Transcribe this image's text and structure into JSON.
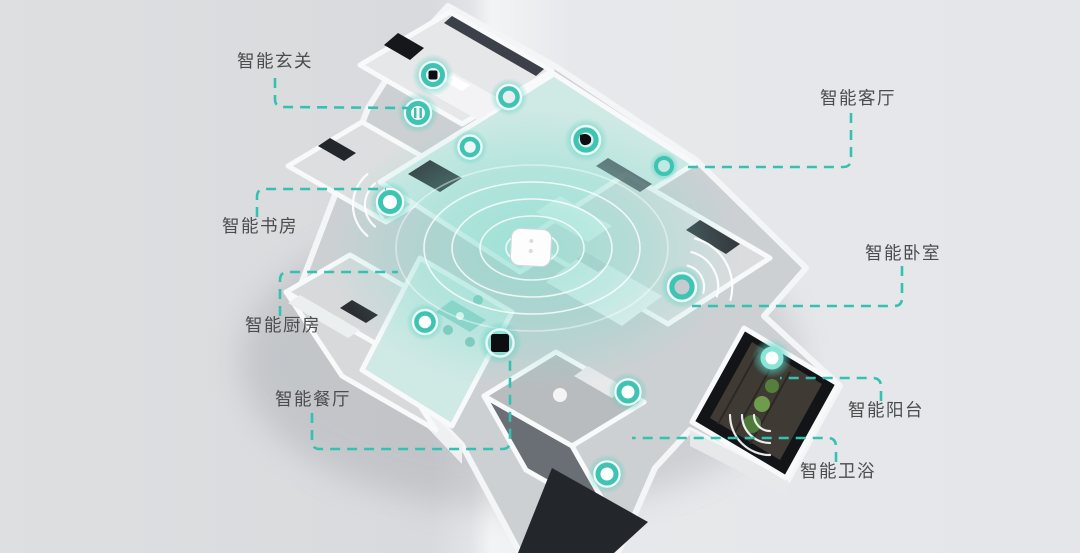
{
  "diagram": {
    "type": "smart-home-isometric-floorplan",
    "callouts": [
      {
        "id": "entryway",
        "label": "智能玄关"
      },
      {
        "id": "living-room",
        "label": "智能客厅"
      },
      {
        "id": "study",
        "label": "智能书房"
      },
      {
        "id": "kitchen",
        "label": "智能厨房"
      },
      {
        "id": "dining-room",
        "label": "智能餐厅"
      },
      {
        "id": "bedroom",
        "label": "智能卧室"
      },
      {
        "id": "balcony",
        "label": "智能阳台"
      },
      {
        "id": "bathroom",
        "label": "智能卫浴"
      }
    ],
    "icons": {
      "hub": "white rounded-square wifi hub with ripple waves",
      "sensor_ring": "teal glowing ring sensor",
      "camera": "black lens in teal ring",
      "control_panel": "black square panel in teal glow",
      "switch": "striped smart switch in teal ring",
      "wifi_waves": "white concentric signal arcs"
    },
    "colors": {
      "leader_dash_teal": "#35c1b1",
      "device_glow_teal": "#5ed6c6",
      "living_room_tint": "#7ddbcc",
      "label_text": "#4b4c4e",
      "background_gray": "#e4e6e9"
    }
  }
}
